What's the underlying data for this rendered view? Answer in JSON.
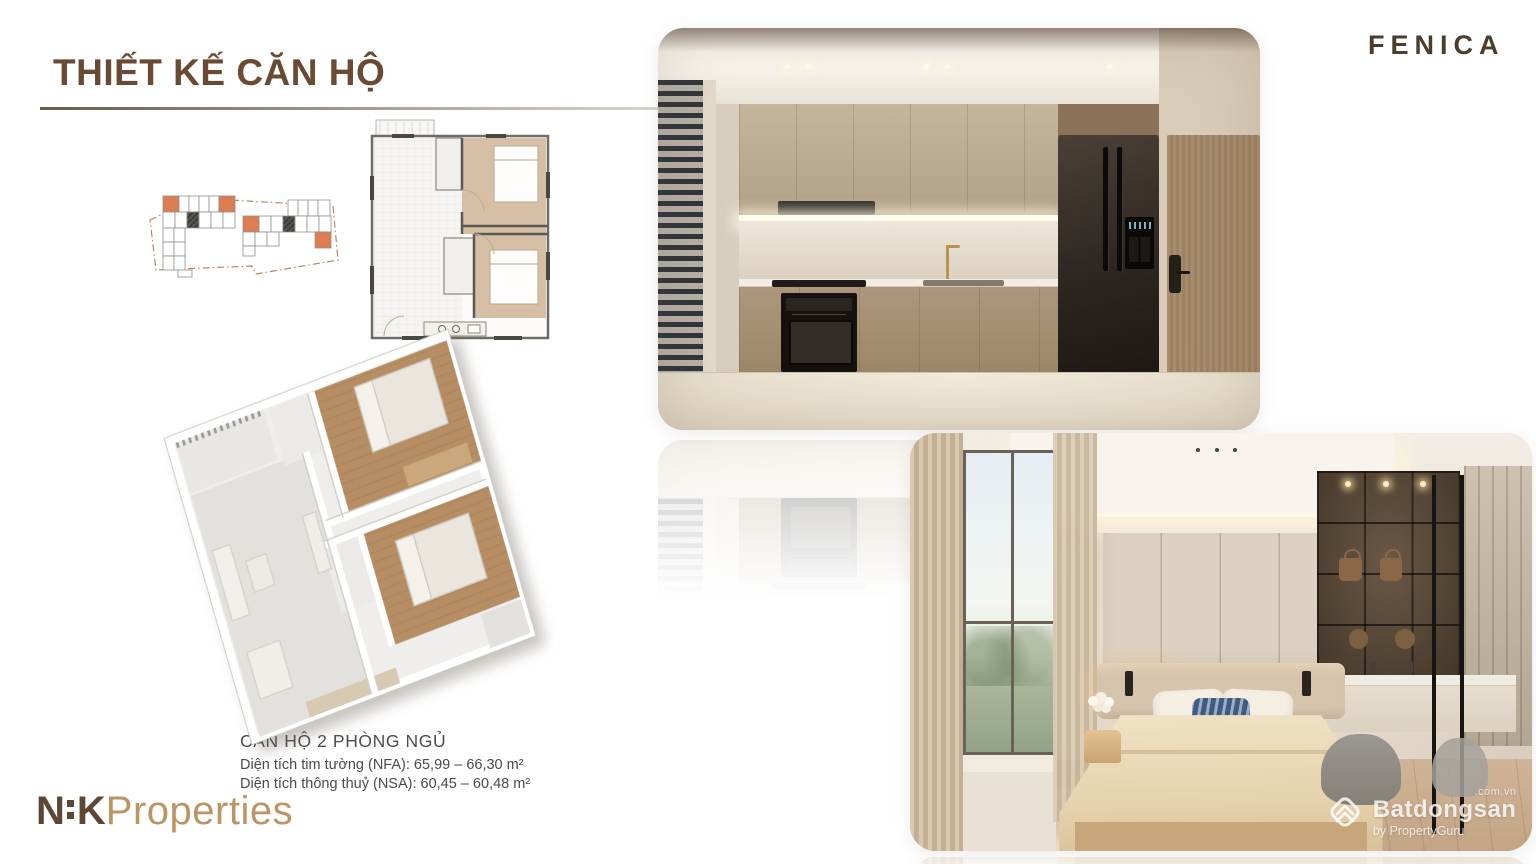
{
  "header": {
    "title": "THIẾT KẾ CĂN HỘ",
    "brand": "FENICA"
  },
  "floor_plans": {
    "unit_name": "CĂN HỘ 2 PHÒNG NGỦ",
    "nfa_line": "Diện tích tim tường (NFA): 65,99 – 66,30 m²",
    "nsa_line": "Diện tích thông thuỷ (NSA): 60,45 – 60,48 m²"
  },
  "developer_logo": {
    "n": "N",
    "k": "K",
    "properties": "Properties"
  },
  "watermark": {
    "icon": "batdongsan-house-icon",
    "suffix": ".com.vn",
    "name": "Batdongsan",
    "byline": "by PropertyGuru"
  },
  "colors": {
    "title_brown": "#6b4a33",
    "brand_brown": "#4d3d2c",
    "logo_dark_brown": "#5d4633",
    "logo_gold": "#bd9565",
    "unit_highlight_orange": "#dd7e52",
    "bedroom_floor_tan": "#d7bfa6"
  }
}
